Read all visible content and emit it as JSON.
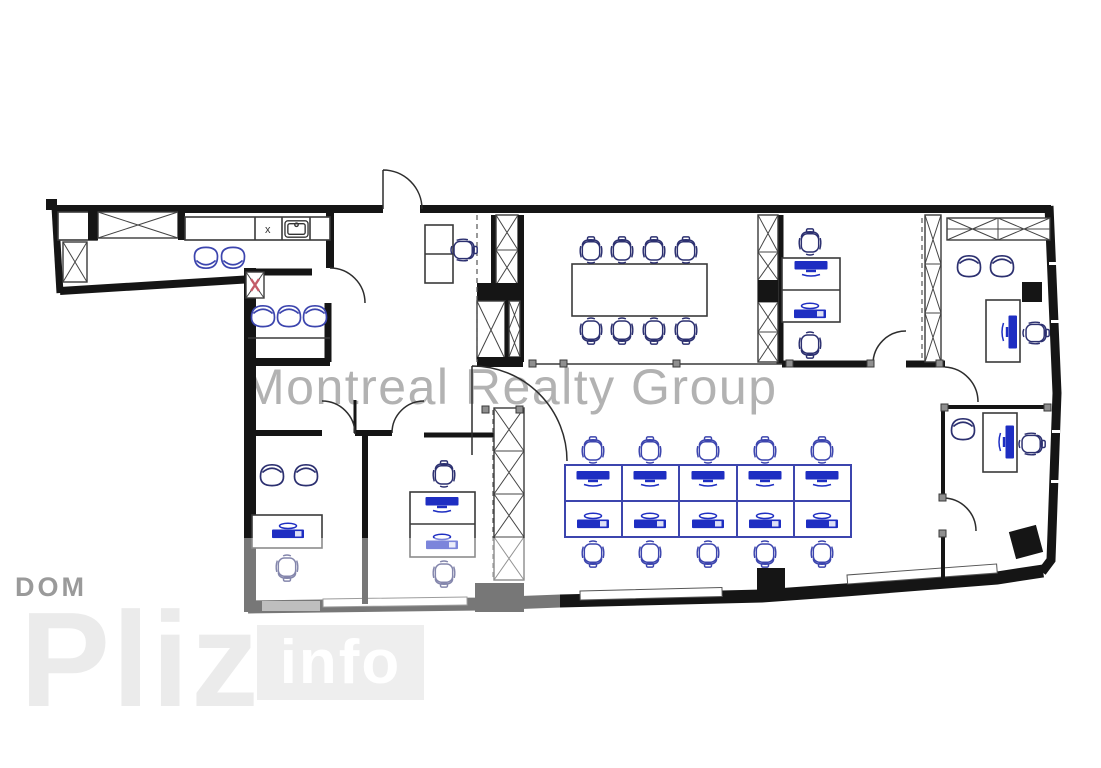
{
  "watermark": {
    "text": "Montreal Realty Group"
  },
  "logo": {
    "dom": "DOM",
    "pliz": "Pliz",
    "info": "info"
  },
  "plan": {
    "kitchen_cell_label": "x"
  },
  "colors": {
    "wall": "#151515",
    "line": "#3a3a3a",
    "fur-dark": "#2c3070",
    "fur-blue": "#3c45ae",
    "monitor": "#1e2ec2",
    "node": "#8f8f8f",
    "red": "#c35b68",
    "watermark": "#b2b2b2",
    "dom": "#9a9a9a",
    "pliz": "#ebebeb",
    "info-box": "#eeeeee",
    "info-text": "#ffffff",
    "window-gray": "#8f8f8f"
  }
}
